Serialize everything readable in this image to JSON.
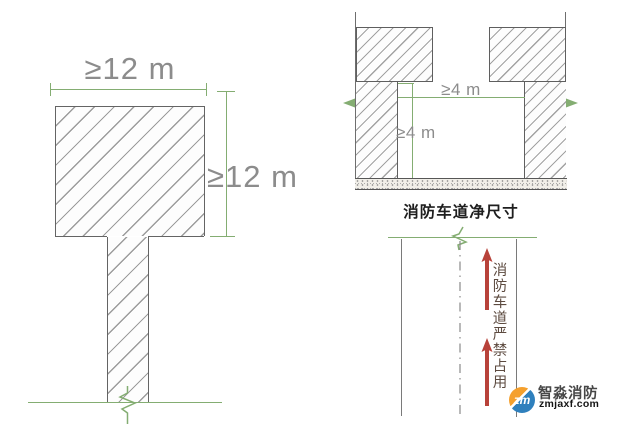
{
  "t_diagram": {
    "top_dim": "≥12 m",
    "side_dim": "≥12 m"
  },
  "section_diagram": {
    "width_dim": "≥4 m",
    "height_dim": "≥4 m",
    "caption": "消防车道净尺寸"
  },
  "plan_diagram": {
    "no_occupy_text": "消防车道严禁占用"
  },
  "logo": {
    "monogram": "zm",
    "brand": "智淼消防",
    "site": "zmjaxf.com"
  },
  "colors": {
    "dimension_green": "#84ad72",
    "structure_gray": "#646464",
    "dimension_text_gray": "#8c8c8c",
    "arrow_red": "#b8423a",
    "vertical_text_brown": "#5d4b40",
    "logo_orange": "#f5a02d",
    "logo_blue": "#2f80bd"
  }
}
